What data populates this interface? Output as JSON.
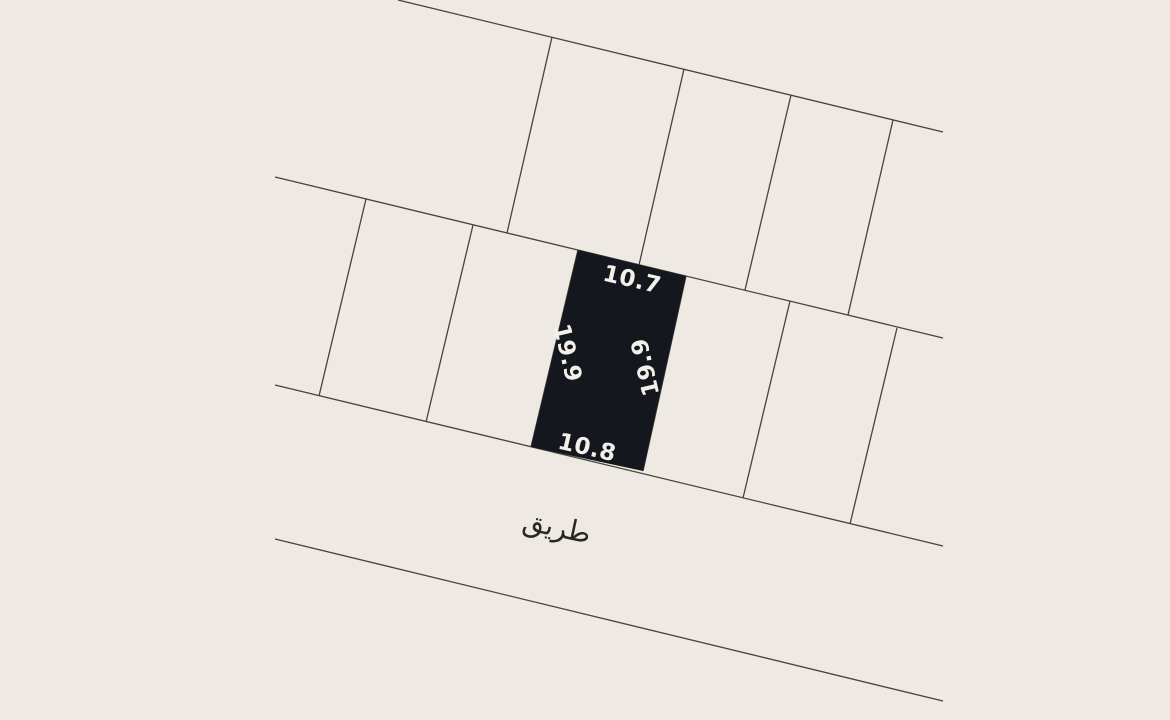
{
  "canvas": {
    "width": 1170,
    "height": 720,
    "background_color": "#eeeae3",
    "line_color": "#46423c",
    "line_width": 1.3
  },
  "plan": {
    "type": "cadastral-parcel-map",
    "selected_parcel": {
      "fill_color": "#15171e",
      "points": "578,250 686,276 643,471 531,447",
      "dimensions": {
        "top": "10.7",
        "bottom": "10.8",
        "left": "19.9",
        "right": "19.9"
      }
    },
    "boundary_lines": [
      {
        "id": "block-top-boundary",
        "x1": 398,
        "y1": 0,
        "x2": 943,
        "y2": 132
      },
      {
        "id": "block-middle-boundary",
        "x1": 275,
        "y1": 177,
        "x2": 943,
        "y2": 338
      },
      {
        "id": "road-top-edge",
        "x1": 275,
        "y1": 385,
        "x2": 943,
        "y2": 546
      },
      {
        "id": "road-bottom-edge",
        "x1": 275,
        "y1": 539,
        "x2": 943,
        "y2": 701
      }
    ],
    "division_lines": [
      {
        "id": "top-row-division-1",
        "x1": 552,
        "y1": 37,
        "x2": 507,
        "y2": 233
      },
      {
        "id": "top-row-division-2",
        "x1": 684,
        "y1": 69,
        "x2": 639,
        "y2": 265
      },
      {
        "id": "top-row-division-3",
        "x1": 791,
        "y1": 95,
        "x2": 745,
        "y2": 290
      },
      {
        "id": "top-row-division-4",
        "x1": 893,
        "y1": 120,
        "x2": 848,
        "y2": 315
      },
      {
        "id": "mid-row-division-1",
        "x1": 366,
        "y1": 199,
        "x2": 319,
        "y2": 396
      },
      {
        "id": "mid-row-division-2",
        "x1": 473,
        "y1": 225,
        "x2": 426,
        "y2": 422
      },
      {
        "id": "mid-row-division-3",
        "x1": 578,
        "y1": 250,
        "x2": 531,
        "y2": 447
      },
      {
        "id": "mid-row-division-4",
        "x1": 686,
        "y1": 276,
        "x2": 643,
        "y2": 471
      },
      {
        "id": "mid-row-division-5",
        "x1": 790,
        "y1": 301,
        "x2": 743,
        "y2": 498
      },
      {
        "id": "mid-row-division-6",
        "x1": 897,
        "y1": 328,
        "x2": 850,
        "y2": 524
      }
    ]
  },
  "labels": [
    {
      "id": "dimension-top",
      "text": "10.7",
      "x": 632,
      "y": 280,
      "rotate": 13,
      "size": 23,
      "color": "#f3f0e9",
      "kind": "dim"
    },
    {
      "id": "dimension-left",
      "text": "19.9",
      "x": 567,
      "y": 353,
      "rotate": 77,
      "size": 23,
      "color": "#f3f0e9",
      "kind": "dim"
    },
    {
      "id": "dimension-right",
      "text": "19.9",
      "x": 646,
      "y": 367,
      "rotate": -103,
      "size": 23,
      "color": "#f3f0e9",
      "kind": "dim"
    },
    {
      "id": "dimension-bottom",
      "text": "10.8",
      "x": 587,
      "y": 448,
      "rotate": 13,
      "size": 23,
      "color": "#f3f0e9",
      "kind": "dim"
    },
    {
      "id": "road-name",
      "text": "طريق",
      "x": 557,
      "y": 527,
      "rotate": 12,
      "size": 28,
      "color": "#2a2721",
      "kind": "road"
    }
  ]
}
